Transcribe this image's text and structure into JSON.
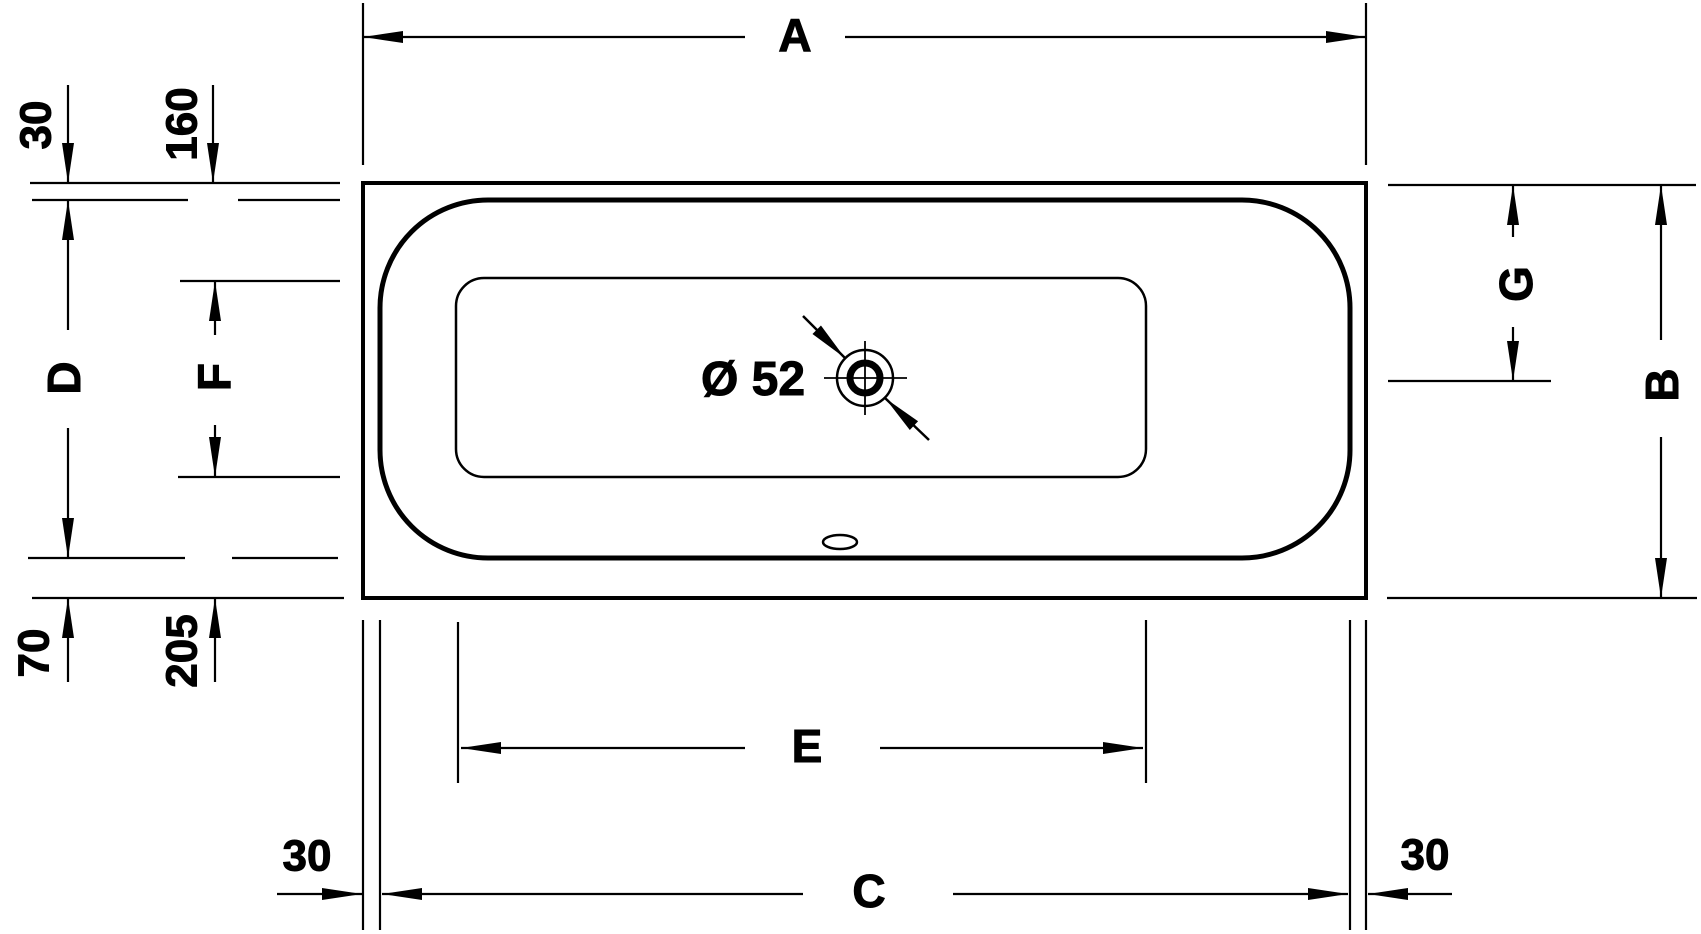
{
  "figure": {
    "kind": "bathtub-top-view-dimension-drawing",
    "colors": {
      "line": "#000000",
      "background": "#ffffff"
    }
  },
  "dim_labels": {
    "A": "A",
    "B": "B",
    "C": "C",
    "D": "D",
    "E": "E",
    "F": "F",
    "G": "G"
  },
  "dim_values": {
    "top_rim": "30",
    "top_deck": "160",
    "bottom_rim": "70",
    "bottom_deck": "205",
    "wall_left": "30",
    "wall_right": "30",
    "drain": "Ø 52"
  }
}
